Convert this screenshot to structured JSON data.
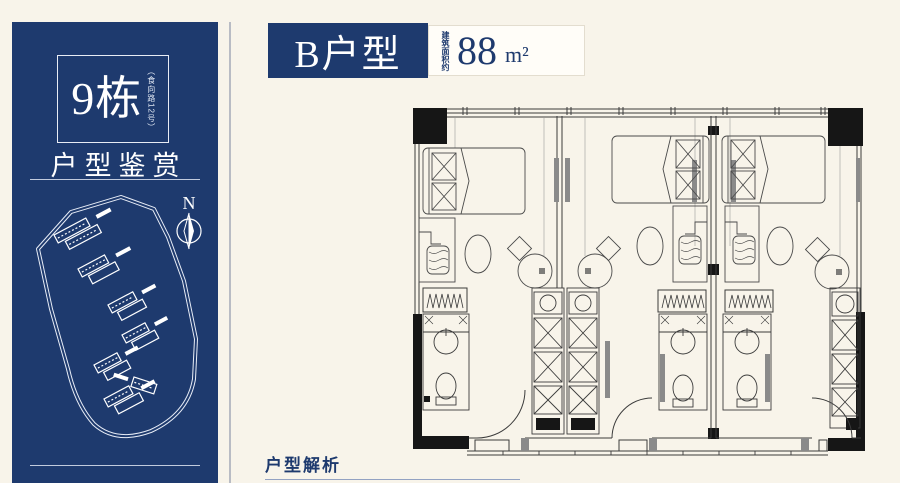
{
  "sidebar": {
    "building_number": "9栋",
    "building_address": "（食向路12号）",
    "subtitle": "户型鉴赏",
    "map": {
      "compass_label": "N"
    }
  },
  "header": {
    "unit_name": "B户型",
    "area_label": "建筑面积约",
    "area_value": "88",
    "area_unit": "m²"
  },
  "footer": {
    "section_title": "户型解析"
  },
  "colors": {
    "brand_blue": "#1e3a6e",
    "background_cream": "#f8f4ea",
    "plan_line": "#3b3b3b"
  }
}
